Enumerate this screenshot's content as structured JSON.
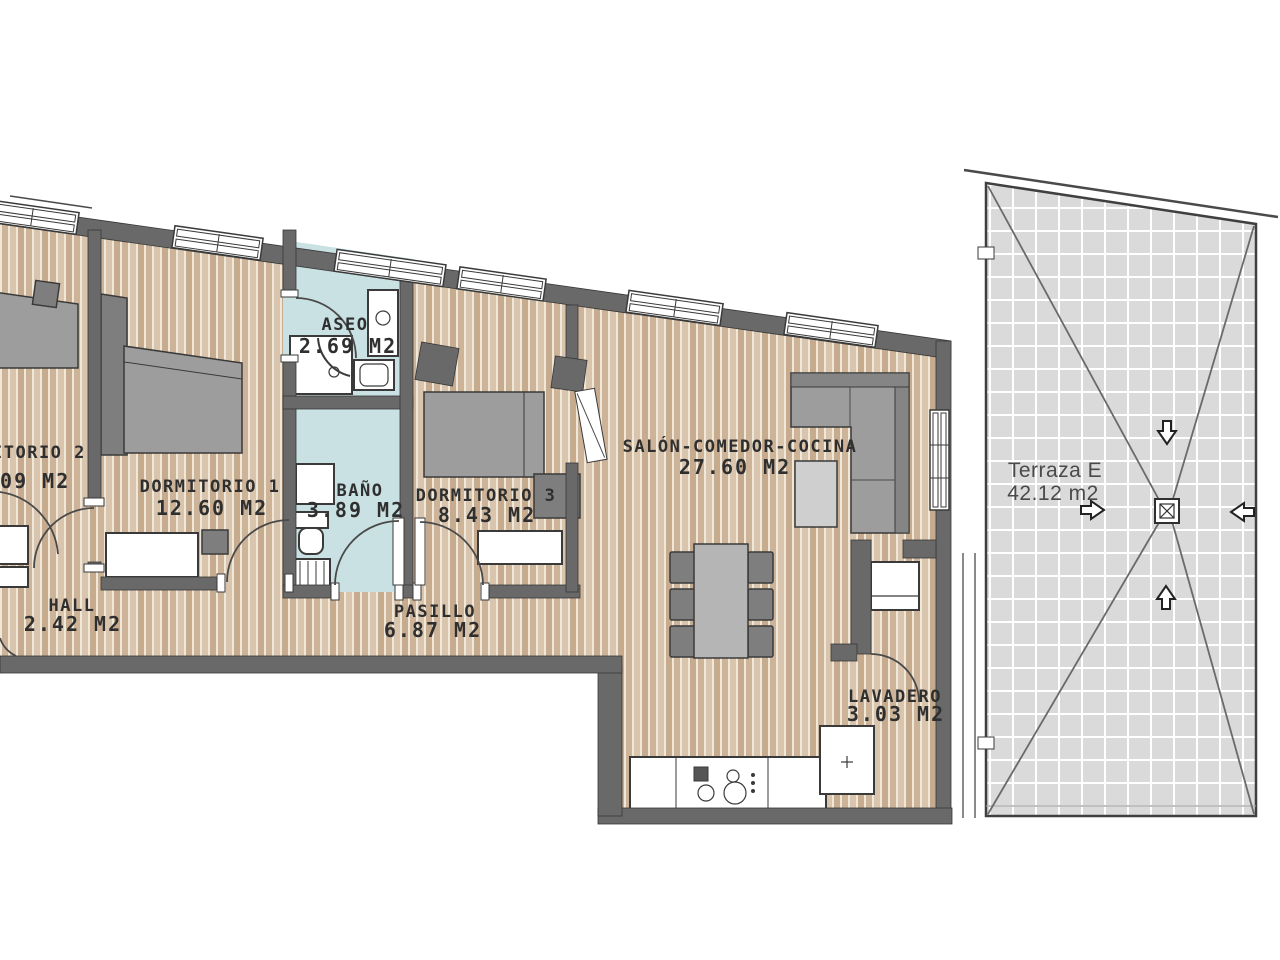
{
  "floorplan": {
    "rooms": {
      "dormitorio2": {
        "label": "ITORIO 2",
        "area": ".09 M2"
      },
      "dormitorio1": {
        "label": "DORMITORIO 1",
        "area": "12.60 M2"
      },
      "aseo": {
        "label": "ASEO",
        "area": "2.69 M2"
      },
      "bano": {
        "label": "BAÑO",
        "area": "3.89 M2"
      },
      "dormitorio3": {
        "label": "DORMITORIO 3",
        "area": "8.43 M2"
      },
      "salon": {
        "label": "SALÓN-COMEDOR-COCINA",
        "area": "27.60 M2"
      },
      "hall": {
        "label": "HALL",
        "area": "2.42 M2"
      },
      "pasillo": {
        "label": "PASILLO",
        "area": "6.87 M2"
      },
      "lavadero": {
        "label": "LAVADERO",
        "area": "3.03 M2"
      },
      "terraza": {
        "label": "Terraza E",
        "area": "42.12 m2"
      }
    },
    "terrace": {
      "slope_arrow_icons": [
        "arrow-down-icon",
        "arrow-up-icon",
        "arrow-left-icon",
        "arrow-right-icon"
      ],
      "drain_icon": "floor-drain-icon"
    },
    "colors": {
      "background": "#ffffff",
      "wall": "#696969",
      "wood_floor": "#cdb499",
      "wood_stripe": "#efe7d8",
      "bathroom_floor": "#c9e1e2",
      "terrace_tile": "#dadada",
      "terrace_grout": "#ffffff",
      "furniture": "#9d9d9d",
      "label_text": "#2f2f2f"
    }
  }
}
